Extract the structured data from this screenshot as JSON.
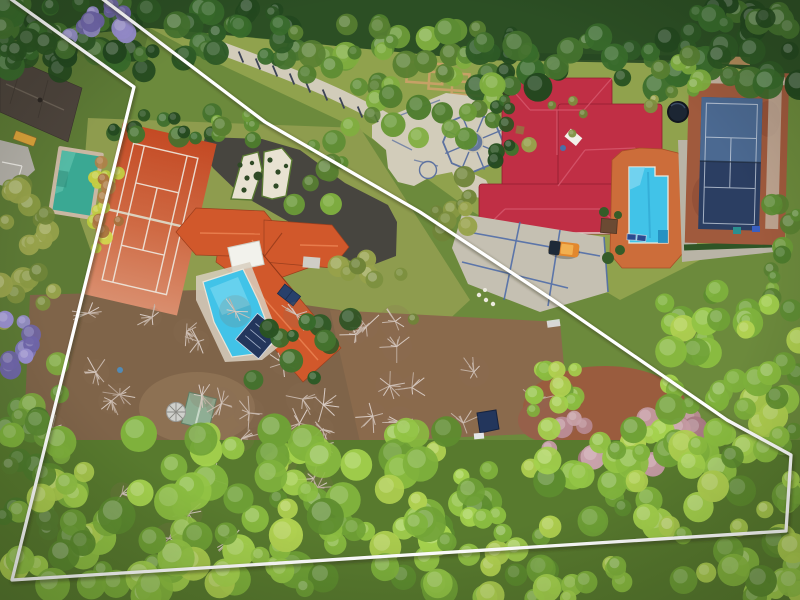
{
  "scene": {
    "type": "aerial-drone-photo",
    "description": "Overhead aerial photograph of two suburban estates surrounded by dense tree canopy, with a white surveyed property-boundary polygon overlaid. The outlined property contains an orange-roofed house, clay tennis court, freeform pool and wooded land; the neighbouring estate (outside the line) has a crimson-roofed mansion, octagonal paved courtyard, blue pool with terracotta deck and a dark blue tennis court."
  },
  "palette": {
    "boundary_white": "#ffffff",
    "clay_court": "#c84e26",
    "clay_court_light": "#d98e6e",
    "roof_orange": "#d1582b",
    "roof_orange_dark": "#9c3f1e",
    "roof_crimson": "#c02f45",
    "roof_crimson_dark": "#8f1f30",
    "pool_cyan": "#41c3e8",
    "pool_teal": "#3aa893",
    "deck_orange": "#cc6d3a",
    "court_navy": "#2b3e62",
    "court_slate": "#4f6e97",
    "court_clay": "#a05a3d",
    "pave_light": "#d2ccba",
    "pave_blue": "#5d72a0",
    "asphalt": "#47453f",
    "shed_green": "#8fae94",
    "car_orange": "#e2882e",
    "lawn_olive": "#8e9c4e",
    "lawn_estate": "#90a24d",
    "dirt_brown": "#7f6449",
    "dirt_red": "#9a5c3e",
    "scrub_brown": "#8a6a4c",
    "forest_dark": "#2c4f24",
    "tarp_navy": "#23365c"
  },
  "boundary": {
    "stroke_width": 3.3,
    "points": [
      [
        8,
        -3
      ],
      [
        134,
        87
      ],
      [
        12,
        580
      ],
      [
        786,
        531
      ],
      [
        791,
        455
      ],
      [
        727,
        420
      ],
      [
        553,
        300
      ],
      [
        420,
        212
      ],
      [
        265,
        122
      ],
      [
        100,
        -3
      ]
    ]
  },
  "objects": {
    "left_property": [
      "clay-tennis-court",
      "orange-roof-house",
      "freeform-pool",
      "pool-cover",
      "garden-shed",
      "patio-umbrella",
      "asphalt-drive",
      "topiary-beds"
    ],
    "estate": [
      "crimson-roof-mansion",
      "octagon-courtyard",
      "long-driveway",
      "estate-pool",
      "pool-deck",
      "sun-loungers",
      "blue-tennis-court",
      "trampoline",
      "grid-driveway",
      "parked-car",
      "garden-frames"
    ],
    "neighbour": [
      "dark-roof-house",
      "teal-pool"
    ]
  },
  "vegetation": {
    "sets": {
      "dark": [
        "#23481f",
        "#2e5a26",
        "#386b2b",
        "#2a5322",
        "#44722e"
      ],
      "mid": [
        "#4e7c2d",
        "#5c8c33",
        "#6b9a38",
        "#7fae3f",
        "#587f31"
      ],
      "bright": [
        "#7fb23c",
        "#93c445",
        "#a4d14d",
        "#6fa136",
        "#8abc40",
        "#b0d050",
        "#5d8c2f"
      ],
      "lime": [
        "#c3cc43",
        "#d2d94e",
        "#b9c93e"
      ],
      "olive": [
        "#7c8f3e",
        "#8a9a44",
        "#6f8438",
        "#97a24b"
      ],
      "rust": [
        "#a8703d",
        "#b08048",
        "#9a6136"
      ],
      "purple": [
        "#8078bd",
        "#9a90d2",
        "#7066ab"
      ],
      "pink": [
        "#b98a94",
        "#c49aa3",
        "#a87983",
        "#c9a3ab"
      ]
    },
    "canopy_regions": [
      [
        0,
        0,
        145,
        72,
        34,
        "dark",
        7,
        15
      ],
      [
        130,
        6,
        180,
        54,
        28,
        "dark",
        7,
        14
      ],
      [
        290,
        22,
        200,
        66,
        28,
        "mid",
        7,
        14
      ],
      [
        470,
        32,
        240,
        56,
        36,
        "dark",
        7,
        15
      ],
      [
        688,
        0,
        112,
        86,
        26,
        "dark",
        8,
        16
      ],
      [
        55,
        0,
        72,
        40,
        11,
        "purple",
        6,
        12
      ],
      [
        0,
        26,
        70,
        46,
        12,
        "dark",
        7,
        13
      ],
      [
        92,
        160,
        32,
        92,
        12,
        "lime",
        5,
        9
      ],
      [
        92,
        162,
        30,
        70,
        8,
        "rust",
        4,
        8
      ],
      [
        0,
        178,
        58,
        150,
        20,
        "olive",
        7,
        13
      ],
      [
        0,
        312,
        34,
        58,
        8,
        "purple",
        6,
        11
      ],
      [
        0,
        362,
        62,
        215,
        24,
        "mid",
        8,
        15
      ],
      [
        106,
        106,
        112,
        34,
        12,
        "dark",
        6,
        11
      ],
      [
        212,
        112,
        62,
        30,
        8,
        "mid",
        5,
        10
      ],
      [
        286,
        140,
        56,
        76,
        9,
        "mid",
        6,
        12
      ],
      [
        345,
        52,
        150,
        88,
        20,
        "mid",
        7,
        13
      ],
      [
        418,
        172,
        64,
        72,
        9,
        "olive",
        6,
        11
      ],
      [
        330,
        248,
        104,
        72,
        9,
        "olive",
        5,
        11
      ],
      [
        488,
        98,
        26,
        72,
        8,
        "dark",
        5,
        9
      ],
      [
        526,
        92,
        160,
        56,
        7,
        "olive",
        4,
        8
      ],
      [
        768,
        196,
        32,
        116,
        11,
        "mid",
        6,
        12
      ],
      [
        655,
        55,
        50,
        40,
        8,
        "mid",
        6,
        11
      ],
      [
        253,
        318,
        118,
        62,
        11,
        "dark",
        6,
        12
      ],
      [
        517,
        345,
        66,
        88,
        11,
        "bright",
        6,
        12
      ],
      [
        545,
        410,
        168,
        58,
        16,
        "pink",
        7,
        13
      ],
      [
        660,
        288,
        142,
        168,
        46,
        "bright",
        8,
        16
      ],
      [
        0,
        428,
        448,
        172,
        115,
        "bright",
        9,
        19
      ],
      [
        445,
        468,
        102,
        132,
        25,
        "bright",
        8,
        16
      ],
      [
        545,
        426,
        255,
        174,
        72,
        "bright",
        8,
        17
      ]
    ],
    "bare_regions": [
      [
        45,
        300,
        280,
        130,
        14
      ],
      [
        120,
        425,
        205,
        120,
        9
      ],
      [
        330,
        318,
        215,
        108,
        11
      ],
      [
        240,
        392,
        88,
        52,
        5
      ]
    ],
    "branch_colors": [
      "#dbcfc8",
      "#cfc0b6",
      "#c3b2a5"
    ]
  }
}
